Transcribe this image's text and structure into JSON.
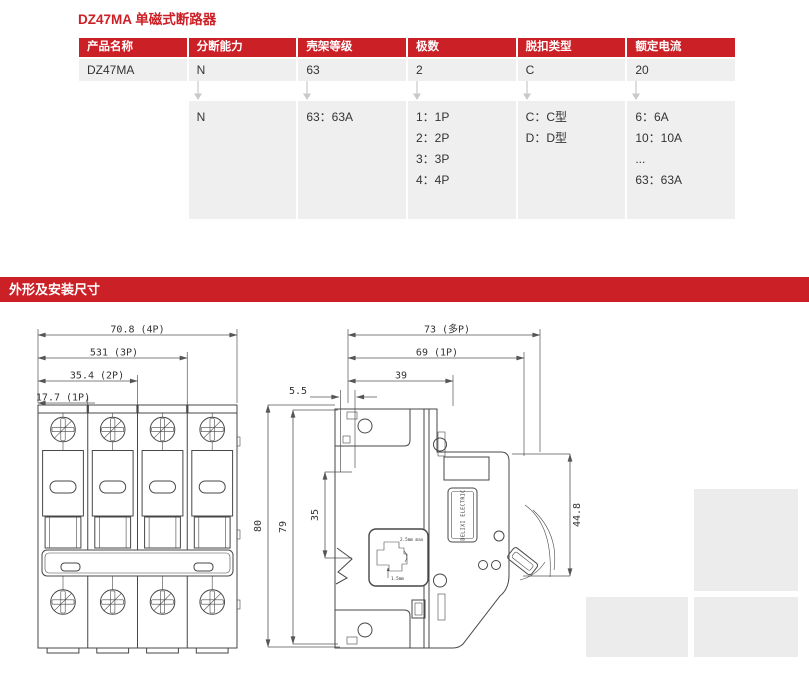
{
  "page": {
    "title": "DZ47MA 单磁式断路器",
    "section_title": "外形及安装尺寸"
  },
  "colors": {
    "accent_red": "#cc2027",
    "row_gray": "#efefef",
    "placeholder_gray": "#ececec",
    "drawing_line": "#474747"
  },
  "icons": {
    "flow_down_arrow": "↓"
  },
  "selection_table": {
    "headers": [
      "产品名称",
      "分断能力",
      "壳架等级",
      "极数",
      "脱扣类型",
      "额定电流"
    ],
    "example": [
      "DZ47MA",
      "N",
      "63",
      "2",
      "C",
      "20"
    ],
    "legend": {
      "breaking_capacity": [
        "N"
      ],
      "frame_level": [
        "63：63A"
      ],
      "poles": [
        "1：1P",
        "2：2P",
        "3：3P",
        "4：4P"
      ],
      "trip_type": [
        "C：C型",
        "D：D型"
      ],
      "rated_current": [
        "6：6A",
        "10：10A",
        "...",
        "63：63A"
      ]
    }
  },
  "drawings": {
    "front_view": {
      "dim_4p": "70.8 (4P)",
      "dim_3p": "531 (3P)",
      "dim_2p": "35.4 (2P)",
      "dim_1p": "17.7 (1P)"
    },
    "side_view": {
      "dim_depth_multi": "73 (多P)",
      "dim_depth_1p": "69 (1P)",
      "dim_rail_width": "39",
      "dim_rail_depth": "5.5",
      "dim_height_outer": "80",
      "dim_height_body": "79",
      "dim_rail_span": "35",
      "dim_front": "44.8",
      "brand_label": "DELIXI ELECTRIC",
      "clip_note_max": "2.5mm max",
      "clip_note_min": "1.5mm"
    }
  }
}
